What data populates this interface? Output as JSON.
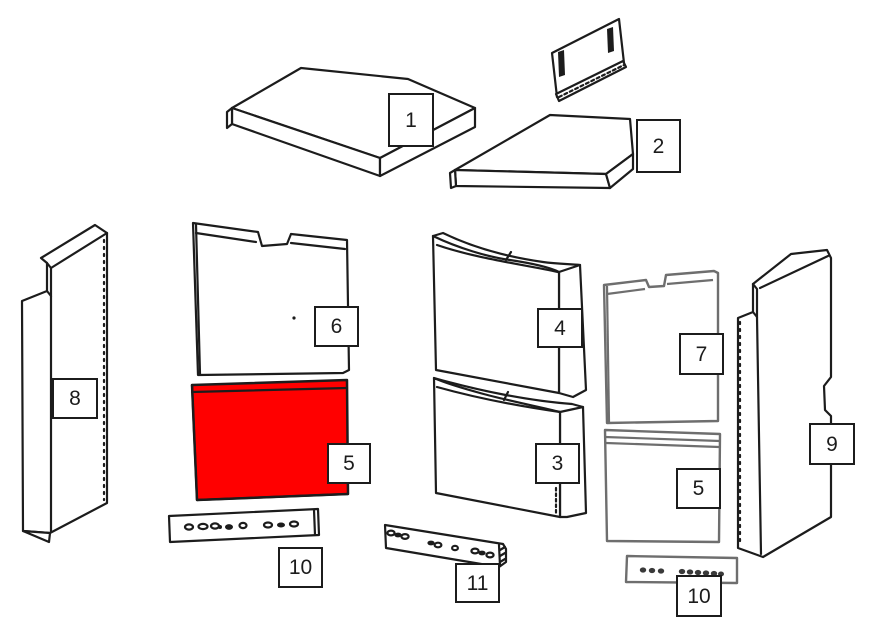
{
  "colors": {
    "background": "#ffffff",
    "line": "#1c1c1c",
    "muted_line": "#6e6e6e",
    "highlight": "#ff0000"
  },
  "callouts": [
    {
      "label": "1"
    },
    {
      "label": "2"
    },
    {
      "label": "6"
    },
    {
      "label": "5"
    },
    {
      "label": "4"
    },
    {
      "label": "3"
    },
    {
      "label": "7"
    },
    {
      "label": "5"
    },
    {
      "label": "8"
    },
    {
      "label": "9"
    },
    {
      "label": "10"
    },
    {
      "label": "11"
    },
    {
      "label": "10"
    }
  ]
}
